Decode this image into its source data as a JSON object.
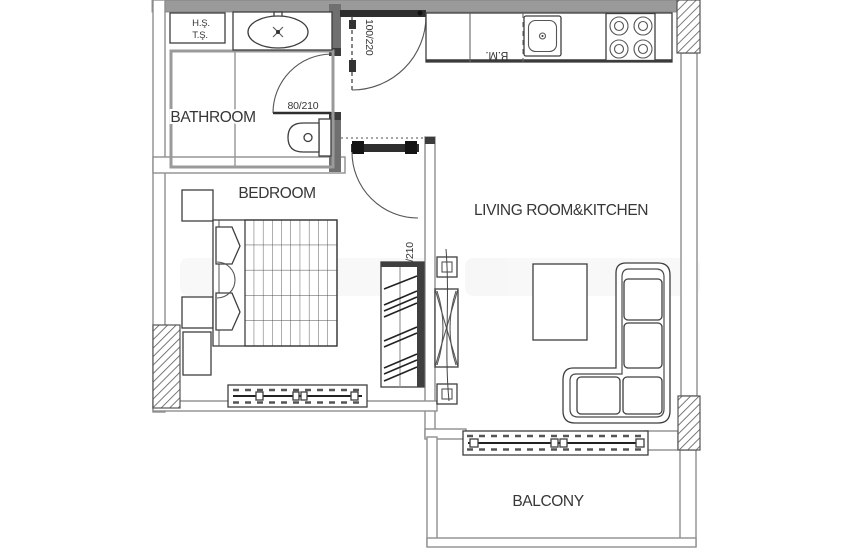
{
  "plan": {
    "type": "apartment-floor-plan",
    "rooms": {
      "bathroom": {
        "label": "BATHROOM"
      },
      "bedroom": {
        "label": "BEDROOM"
      },
      "living_kitchen": {
        "label": "LIVING ROOM&KITCHEN"
      },
      "balcony": {
        "label": "BALCONY"
      }
    },
    "doors": {
      "bathroom_door": {
        "size_label": "80/210"
      },
      "entry_door": {
        "size_label": "100/220"
      },
      "bedroom_door": {
        "size_label": "90/210"
      }
    },
    "annotations": {
      "shaft_line1": "H.Ş.",
      "shaft_line2": "T.Ş.",
      "kitchen_cabinet": "B.M."
    },
    "colors": {
      "wall_line": "#8f8f8f",
      "dark_line": "#3c3c3c",
      "text": "#373737",
      "background": "#ffffff"
    }
  }
}
